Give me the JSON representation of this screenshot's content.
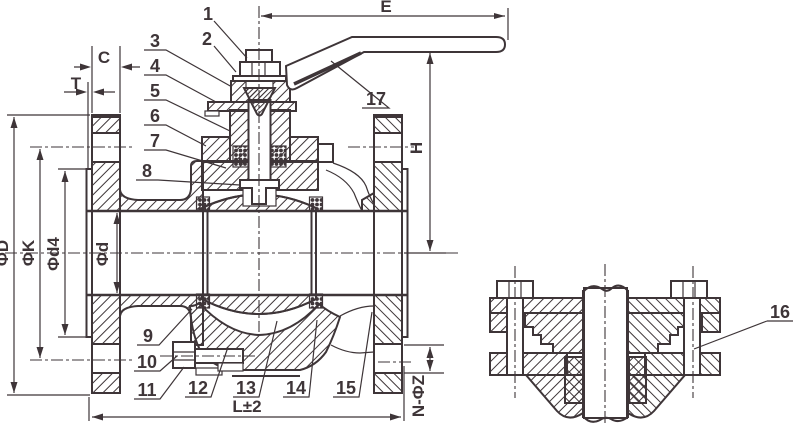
{
  "meta": {
    "kind": "technical engineering drawing",
    "subject": "flanged ball valve cross-section with part callouts and mounting-section detail view"
  },
  "colors": {
    "ink": "#3e3538",
    "paper": "#ffffff"
  },
  "labels": {
    "parts": {
      "p1": "1",
      "p2": "2",
      "p3": "3",
      "p4": "4",
      "p5": "5",
      "p6": "6",
      "p7": "7",
      "p8": "8",
      "p9": "9",
      "p10": "10",
      "p11": "11",
      "p12": "12",
      "p13": "13",
      "p14": "14",
      "p15": "15",
      "p16": "16",
      "p17": "17"
    },
    "dims": {
      "e": "E",
      "h": "H",
      "c": "C",
      "t": "T",
      "phiD": "ΦD",
      "phiK": "ΦK",
      "phid4": "Φd4",
      "phid": "Φd",
      "l": "L±2",
      "nphiz": "N-ΦZ"
    }
  }
}
